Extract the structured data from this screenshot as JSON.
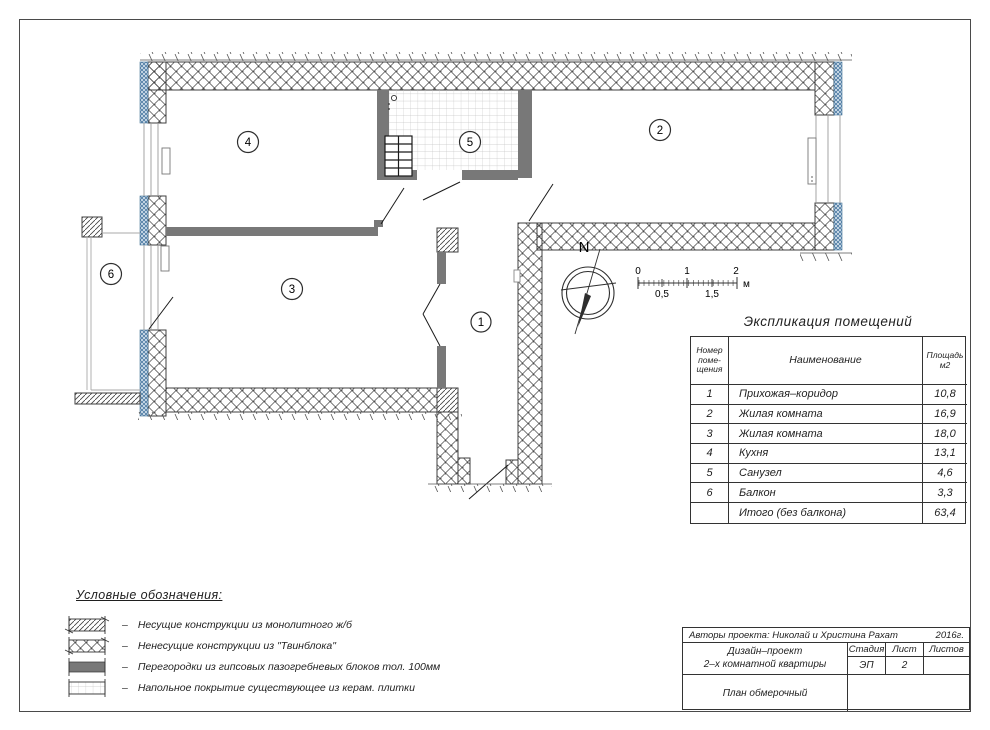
{
  "colors": {
    "accent_blue": "#4e7ba3",
    "partition_gray": "#787878",
    "line_dark": "#3f3f3f",
    "thin_gray": "#9a9a9a"
  },
  "plan": {
    "room_labels": {
      "r1": "1",
      "r2": "2",
      "r3": "3",
      "r4": "4",
      "r5": "5",
      "r6": "6"
    },
    "north": "N",
    "scalebar": {
      "t0": "0",
      "t1": "1",
      "t2": "2",
      "b0": "0,5",
      "b1": "1,5",
      "unit": "м"
    }
  },
  "table": {
    "title": "Экспликация помещений",
    "header": {
      "num_l1": "Номер",
      "num_l2": "поме-",
      "num_l3": "щения",
      "name": "Наименование",
      "area_l1": "Площадь",
      "area_l2": "м2"
    },
    "rows": [
      {
        "num": "1",
        "name": "Прихожая–коридор",
        "area": "10,8"
      },
      {
        "num": "2",
        "name": "Жилая комната",
        "area": "16,9"
      },
      {
        "num": "3",
        "name": "Жилая комната",
        "area": "18,0"
      },
      {
        "num": "4",
        "name": "Кухня",
        "area": "13,1"
      },
      {
        "num": "5",
        "name": "Санузел",
        "area": "4,6"
      },
      {
        "num": "6",
        "name": "Балкон",
        "area": "3,3"
      },
      {
        "num": "",
        "name": "Итого (без балкона)",
        "area": "63,4"
      }
    ]
  },
  "legend": {
    "title": "Условные обозначения:",
    "dash": "–",
    "items": [
      {
        "text": "Несущие конструкции из монолитного ж/б"
      },
      {
        "text": "Ненесущие конструкции из \"Твинблока\""
      },
      {
        "text": "Перегородки из гипсовых пазогребневых блоков тол. 100мм"
      },
      {
        "text": "Напольное покрытие существующее из керам. плитки"
      }
    ]
  },
  "titleblock": {
    "authors": "Авторы проекта: Николай и Христина Рахат",
    "year": "2016г.",
    "project_l1": "Дизайн–проект",
    "project_l2": "2–х комнатной квартиры",
    "stage_label": "Стадия",
    "sheet_label": "Лист",
    "sheets_label": "Листов",
    "stage_value": "ЭП",
    "sheet_value": "2",
    "sheets_value": "",
    "drawing_name": "План обмерочный"
  }
}
